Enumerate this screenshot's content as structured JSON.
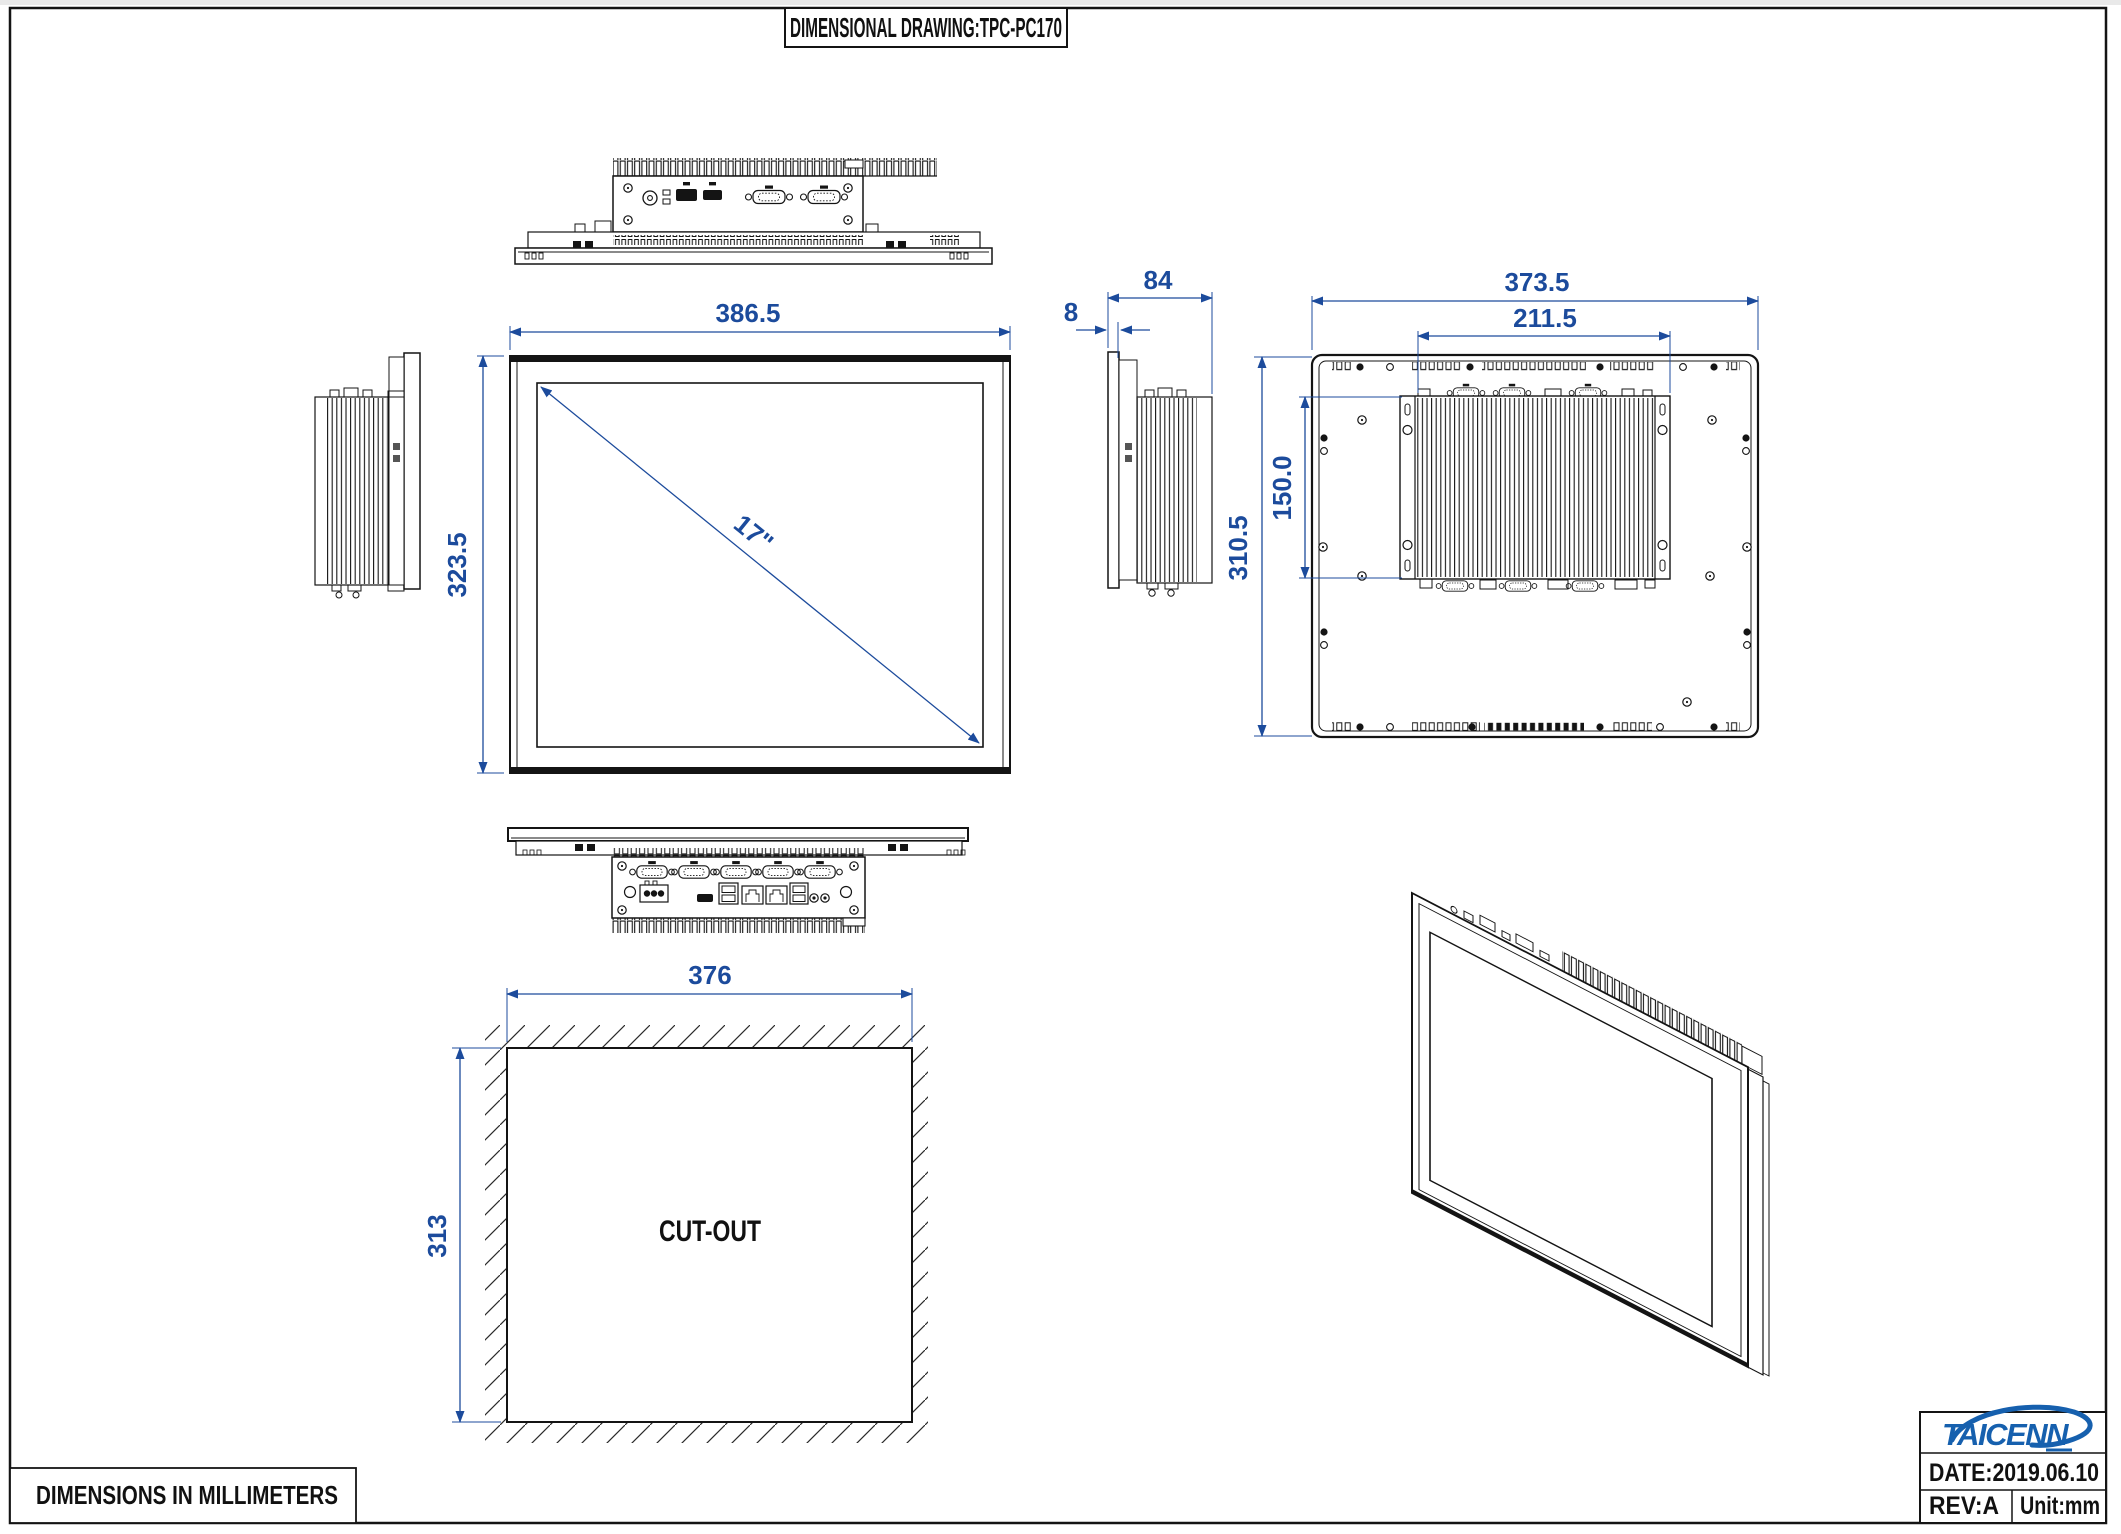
{
  "header": {
    "title": "DIMENSIONAL DRAWING:TPC-PC170"
  },
  "views": {
    "front": {
      "width_mm": "386.5",
      "height_mm": "323.5",
      "diagonal": "17\""
    },
    "side": {
      "depth_mm": "84",
      "front_bezel_mm": "8"
    },
    "rear": {
      "width_mm": "373.5",
      "mount_width_mm": "211.5",
      "height_mm": "310.5",
      "mount_height_mm": "150.0"
    },
    "cutout": {
      "label": "CUT-OUT",
      "width_mm": "376",
      "height_mm": "313"
    }
  },
  "footer": {
    "note": "DIMENSIONS IN MILLIMETERS"
  },
  "title_block": {
    "brand": "TAICENN",
    "date": "DATE:2019.06.10",
    "revision": "REV:A",
    "unit": "Unit:mm"
  },
  "colors": {
    "dimension": "#1c4b9c",
    "brand_blue": "#1660ae",
    "ink": "#141414"
  }
}
